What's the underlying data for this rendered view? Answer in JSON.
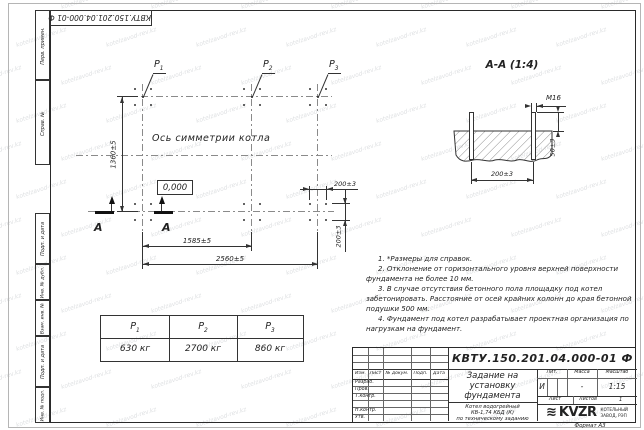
{
  "sheet": {
    "doc_number": "КВТУ.150.201.04.000-01 Ф",
    "format_label": "Формат А3",
    "watermark": "kotelzavod-rev.kz"
  },
  "margin_stamps": {
    "perv_primen": "Перв. примен.",
    "sprav_no": "Справ. №",
    "podp_data_1": "Подп. и дата",
    "inv_dubl": "Инв. № дубл.",
    "vzam_inv": "Взам. инв. №",
    "podp_data_2": "Подп. и дата",
    "inv_podl": "Инв. № подл."
  },
  "plan": {
    "symmetry_axis_label": "Ось симметрии котла",
    "elevation_mark": "0,000",
    "labels": {
      "p1": {
        "base": "Р",
        "sub": "1"
      },
      "p2": {
        "base": "Р",
        "sub": "2"
      },
      "p3": {
        "base": "Р",
        "sub": "3"
      }
    },
    "dimensions": {
      "height": "1360±5",
      "span_p1_p2": "1585±5",
      "span_p1_p3": "2560±5",
      "bolt_spacing_x": "200±3",
      "bolt_spacing_y": "200±3"
    },
    "section_letter": "А"
  },
  "section_view": {
    "title": "А-А (1:4)",
    "thread_label": "М16",
    "dimensions": {
      "protrusion": "50±3",
      "bolt_spacing": "200±3"
    }
  },
  "notes": [
    "1. *Размеры для справок.",
    "2. Отклонение от горизонтального уровня верхней поверхности фундамента не более 10 мм.",
    "3. В случае отсутствия бетонного пола площадку под котел забетонировать. Расстояние от осей крайних колонн до края бетонной подушки 500 мм.",
    "4. Фундамент под котел разрабатывает проектная организация по нагрузкам на фундамент."
  ],
  "load_table": {
    "headers": [
      {
        "base": "Р",
        "sub": "1"
      },
      {
        "base": "Р",
        "sub": "2"
      },
      {
        "base": "Р",
        "sub": "3"
      }
    ],
    "values": [
      "630 кг",
      "2700 кг",
      "860 кг"
    ]
  },
  "title_block": {
    "doc_number": "КВТУ.150.201.04.000-01 Ф",
    "title_lines": [
      "Задание на",
      "установку",
      "фундамента"
    ],
    "product_lines": [
      "Котел водогрейный",
      "КВ-1,74 КБД (К)",
      "по техническому заданию"
    ],
    "columns": {
      "izm": "Изм.",
      "list": "Лист",
      "doc": "№ докум.",
      "podp": "Подп.",
      "data": "Дата"
    },
    "rows": {
      "razrab": "Разраб.",
      "prov": "Пров.",
      "tkontr": "Т.контр.",
      "nkontr": "Н.контр.",
      "utv": "Утв."
    },
    "lit_label": "Лит.",
    "mass_label": "Масса",
    "scale_label": "Масштаб",
    "lit_value": "И",
    "mass_value": "-",
    "scale_value": "1:15",
    "sheet_label": "Лист",
    "sheets_label": "Листов",
    "sheets_value": "1",
    "logo_text": "KVZR",
    "logo_caption_lines": [
      "КОТЕЛЬНЫЙ",
      "ЗАВОД, РЭП"
    ]
  }
}
